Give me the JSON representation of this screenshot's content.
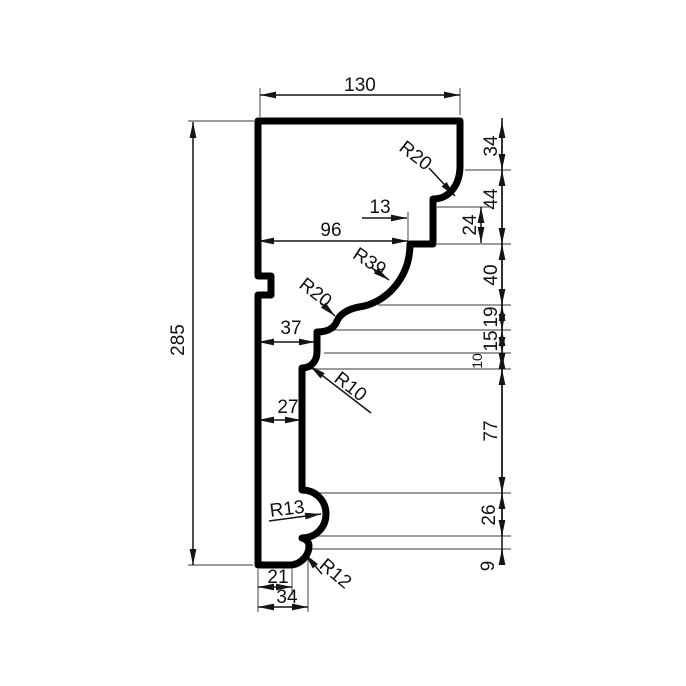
{
  "drawing": {
    "kind": "molding-profile-dimension-drawing",
    "canvas": {
      "width": 686,
      "height": 686,
      "background": "#ffffff"
    },
    "colors": {
      "profile": "#000000",
      "dimension": "#141414",
      "extension": "#7a7a7a",
      "text": "#111111"
    },
    "stroke": {
      "profile_width": 7,
      "dimension_width": 1.5,
      "extension_width": 1.4
    },
    "font": {
      "size_default": 19,
      "size_small": 14
    },
    "profile_path": "M 258 121 L 460 121 L 460 166 C 460 184 450 199 433 199 L 433 244 L 410 244 C 410 277 387 303 359 307 C 348 309 340 314 337 321 C 334 329 326 332 317 332 L 317 352 C 317 361 311 368 302 368 L 302 490 C 315 490 326 500 326 514 C 326 528 315 538 302 538 C 306 539 309 542 309 546 C 309 554 303 563 292 565 L 258 565 L 258 295 L 271 295 L 271 276 L 258 276 Z",
    "extension_lines": [
      [
        188,
        121,
        254,
        121
      ],
      [
        188,
        565,
        253,
        565
      ],
      [
        260,
        88,
        260,
        117
      ],
      [
        460,
        88,
        460,
        115
      ],
      [
        408,
        212,
        408,
        250
      ],
      [
        465,
        170,
        511,
        170
      ],
      [
        437,
        207,
        489,
        207
      ],
      [
        437,
        244,
        511,
        244
      ],
      [
        378,
        305,
        511,
        305
      ],
      [
        332,
        330,
        511,
        330
      ],
      [
        324,
        353,
        511,
        353
      ],
      [
        306,
        369,
        511,
        369
      ],
      [
        308,
        493,
        511,
        493
      ],
      [
        311,
        536,
        511,
        536
      ],
      [
        310,
        549,
        511,
        549
      ],
      [
        258,
        569,
        258,
        612
      ],
      [
        292,
        569,
        292,
        595
      ],
      [
        308,
        553,
        308,
        612
      ]
    ],
    "chain_line": {
      "x": 502,
      "y1": 118,
      "y2": 560
    },
    "linear_dimensions": [
      {
        "label": "130",
        "x1": 260,
        "y1": 95,
        "x2": 460,
        "y2": 95,
        "tx": 360,
        "ty": 84,
        "rot": 0,
        "s": true,
        "e": true
      },
      {
        "label": "285",
        "x1": 193,
        "y1": 122,
        "x2": 193,
        "y2": 565,
        "tx": 177,
        "ty": 340,
        "rot": -90,
        "s": true,
        "e": true
      },
      {
        "label": "96",
        "x1": 258,
        "y1": 241,
        "x2": 408,
        "y2": 241,
        "tx": 331,
        "ty": 229,
        "rot": 0,
        "s": true,
        "e": true
      },
      {
        "label": "13",
        "x1": 362,
        "y1": 218,
        "x2": 407,
        "y2": 218,
        "tx": 380,
        "ty": 206,
        "rot": 0,
        "s": false,
        "e": true
      },
      {
        "label": "37",
        "x1": 258,
        "y1": 342,
        "x2": 315,
        "y2": 342,
        "tx": 291,
        "ty": 327,
        "rot": 0,
        "s": true,
        "e": true
      },
      {
        "label": "27",
        "x1": 258,
        "y1": 420,
        "x2": 301,
        "y2": 420,
        "tx": 288,
        "ty": 406,
        "rot": 0,
        "s": true,
        "e": true
      },
      {
        "label": "21",
        "x1": 258,
        "y1": 587,
        "x2": 292,
        "y2": 587,
        "tx": 278,
        "ty": 576,
        "rot": 0,
        "s": true,
        "e": true
      },
      {
        "label": "34",
        "x1": 258,
        "y1": 607,
        "x2": 308,
        "y2": 607,
        "tx": 287,
        "ty": 596,
        "rot": 0,
        "s": true,
        "e": true
      },
      {
        "label": "24",
        "x1": 481,
        "y1": 207,
        "x2": 481,
        "y2": 243,
        "tx": 469,
        "ty": 225,
        "rot": -90,
        "s": true,
        "e": true
      },
      {
        "label": "34",
        "x1": 502,
        "y1": 122,
        "x2": 502,
        "y2": 170,
        "tx": 490,
        "ty": 146,
        "rot": -90,
        "s": true,
        "e": true
      },
      {
        "label": "44",
        "x1": 502,
        "y1": 170,
        "x2": 502,
        "y2": 244,
        "tx": 490,
        "ty": 199,
        "rot": -90,
        "s": true,
        "e": true
      },
      {
        "label": "40",
        "x1": 502,
        "y1": 244,
        "x2": 502,
        "y2": 305,
        "tx": 490,
        "ty": 275,
        "rot": -90,
        "s": true,
        "e": true
      },
      {
        "label": "19",
        "x1": 502,
        "y1": 305,
        "x2": 502,
        "y2": 330,
        "tx": 490,
        "ty": 317,
        "rot": -90,
        "s": true,
        "e": true
      },
      {
        "label": "15",
        "x1": 502,
        "y1": 330,
        "x2": 502,
        "y2": 353,
        "tx": 490,
        "ty": 341,
        "rot": -90,
        "s": true,
        "e": true
      },
      {
        "label": "10",
        "x1": 502,
        "y1": 353,
        "x2": 502,
        "y2": 369,
        "tx": 477,
        "ty": 361,
        "rot": -90,
        "s": true,
        "e": true,
        "small": true
      },
      {
        "label": "77",
        "x1": 502,
        "y1": 369,
        "x2": 502,
        "y2": 493,
        "tx": 490,
        "ty": 431,
        "rot": -90,
        "s": true,
        "e": true
      },
      {
        "label": "26",
        "x1": 502,
        "y1": 493,
        "x2": 502,
        "y2": 536,
        "tx": 488,
        "ty": 515,
        "rot": -90,
        "s": true,
        "e": true
      },
      {
        "label": "9",
        "x1": 502,
        "y1": 549,
        "x2": 502,
        "y2": 558,
        "tx": 487,
        "ty": 566,
        "rot": -90,
        "s": true,
        "e": false
      }
    ],
    "radius_leaders": [
      {
        "label": "R20",
        "lx1": 429,
        "ly1": 168,
        "lx2": 455,
        "ly2": 196,
        "tx": 416,
        "ty": 155,
        "rot": 38
      },
      {
        "label": "R39",
        "lx1": 372,
        "ly1": 268,
        "lx2": 389,
        "ly2": 280,
        "tx": 370,
        "ty": 261,
        "rot": 33
      },
      {
        "label": "R20",
        "lx1": 321,
        "ly1": 303,
        "lx2": 335,
        "ly2": 316,
        "tx": 316,
        "ty": 292,
        "rot": 38
      },
      {
        "label": "R10",
        "lx1": 371,
        "ly1": 413,
        "lx2": 310,
        "ly2": 366,
        "tx": 351,
        "ty": 386,
        "rot": 38
      },
      {
        "label": "R13",
        "lx1": 269,
        "ly1": 521,
        "lx2": 321,
        "ly2": 514,
        "tx": 287,
        "ty": 508,
        "rot": -7
      },
      {
        "label": "R12",
        "lx1": 322,
        "ly1": 574,
        "lx2": 305,
        "ly2": 554,
        "tx": 336,
        "ty": 573,
        "rot": 40
      }
    ]
  }
}
